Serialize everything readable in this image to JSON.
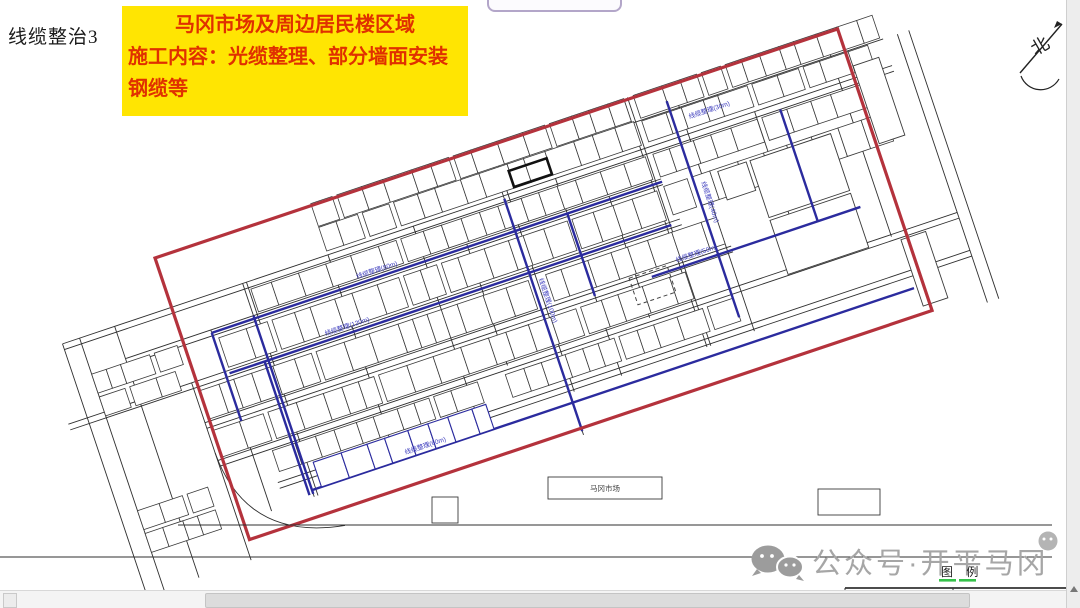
{
  "header": {
    "doc_label": "线缆整治3"
  },
  "banner": {
    "line1": "马冈市场及周边居民楼区域",
    "line2": "施工内容：光缆整理、部分墙面安装",
    "line3": "钢缆等"
  },
  "map": {
    "north_label": "北",
    "cable_labels": [
      "线缆整理(30m)",
      "线缆整理(80m)",
      "线缆整理(120m)",
      "线缆整理(50m)",
      "线缆整理(100m)",
      "线缆整理(60m)",
      "线缆整理(40m)"
    ],
    "building_labels": [
      "马冈市场"
    ],
    "colors": {
      "boundary": "#b4323c",
      "cable": "#2b2b9e"
    }
  },
  "legend": {
    "title": "图 例",
    "col_symbol": "符 号",
    "col_desc": "说 明"
  },
  "watermark": {
    "text": "公众号·开平马冈"
  }
}
